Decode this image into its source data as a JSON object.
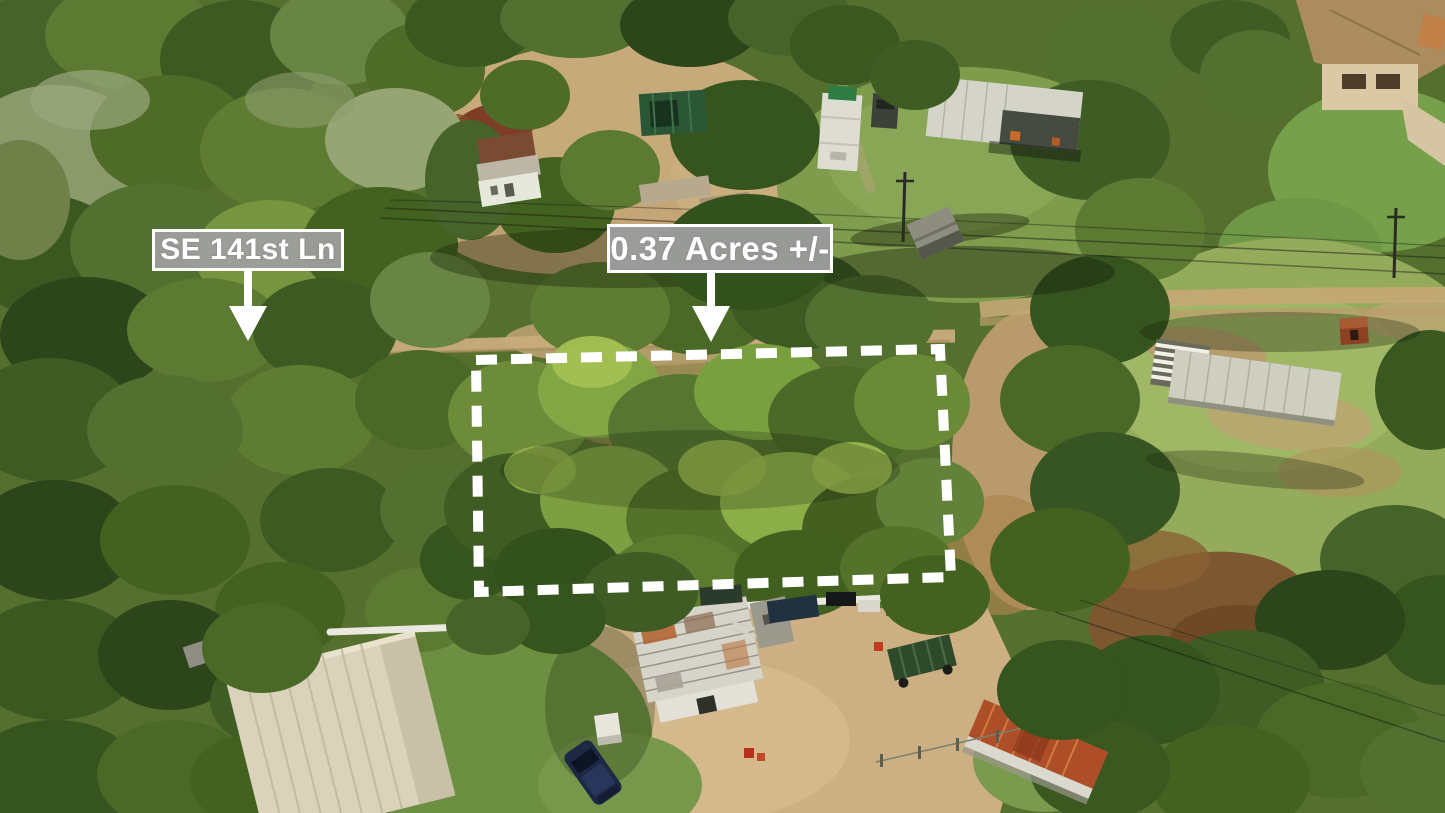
{
  "image": {
    "type": "aerial-drone-photo",
    "scene": "wooded vacant residential lot surrounded by homes, sheds, trailers and dirt lanes"
  },
  "annotations": {
    "street": {
      "text": "SE 141st Ln",
      "icon": "down-arrow-icon"
    },
    "acreage": {
      "text": "0.37 Acres +/-",
      "icon": "down-arrow-icon"
    },
    "parcel_boundary": {
      "shape": "dashed-rectangle",
      "color": "#ffffff"
    },
    "label_style": {
      "background": "#9e9e9e",
      "border": "#ffffff",
      "text_color": "#ffffff"
    }
  }
}
